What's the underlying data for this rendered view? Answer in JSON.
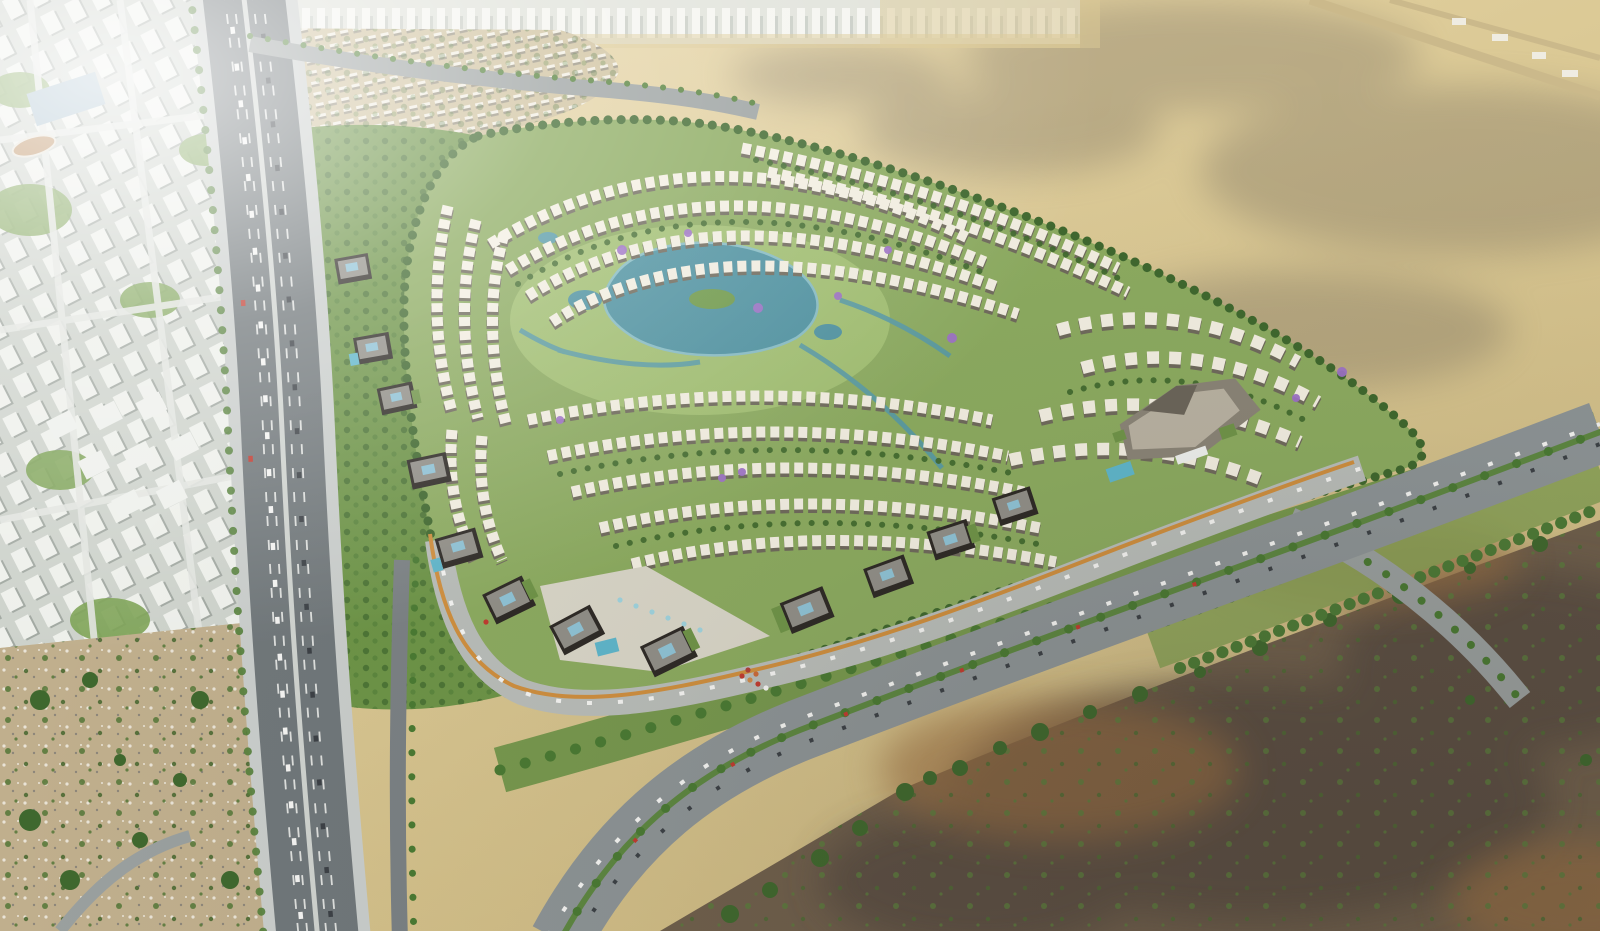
{
  "scene": {
    "type": "architectural-aerial-render",
    "description": "Aerial rendering of a master-planned residential community with curved rows of white villas, a central lagoon park with jacaranda trees, dark glass office buildings along a curved boulevard with an orange cycle path, bordered by an elevated expressway and city blocks on the left, open desert with cloud shadows at the top right, and dark mudflats with scattered trees at the bottom right.",
    "regions": [
      {
        "name": "city-district",
        "label": "existing city with white apartment towers"
      },
      {
        "name": "skyline-strip",
        "label": "distant city skyline on horizon"
      },
      {
        "name": "expressway",
        "label": "multi-lane expressway with traffic"
      },
      {
        "name": "low-rise-district",
        "label": "beige low-rise neighborhood"
      },
      {
        "name": "community-parcel",
        "label": "master-planned villa community"
      },
      {
        "name": "lagoon",
        "label": "central lagoon and park"
      },
      {
        "name": "office-row",
        "label": "dark glass office buildings with green roofs"
      },
      {
        "name": "retail-center",
        "label": "commercial center with pools"
      },
      {
        "name": "boulevard",
        "label": "curved boulevard with orange cycle lane"
      },
      {
        "name": "arterial-road",
        "label": "palm-lined arterial road with traffic"
      },
      {
        "name": "desert",
        "label": "open sand desert with cloud shadows"
      },
      {
        "name": "mudflat",
        "label": "dark brown mudflats with shrubs"
      },
      {
        "name": "rough-terrain",
        "label": "rocky scrubland"
      }
    ],
    "palette": {
      "desert_sand": "#dbc995",
      "desert_light": "#ead9ad",
      "desert_deep": "#cdb981",
      "cloud_shadow": "#6f685c",
      "city_base": "#cdd2cb",
      "city_block_white": "#f4f5f1",
      "city_shadow": "#99a09a",
      "street_light": "#e3e5e1",
      "skyline_base": "#e0e3dd",
      "blue_building": "#a3bccb",
      "district_tan": "#cfc19d",
      "house_white": "#f2eee2",
      "house_roof": "#98917f",
      "greenbelt": "#6d9447",
      "tree_dark": "#3f682e",
      "tree_mid": "#54803a",
      "palm_green": "#4a7a33",
      "parcel_green": "#8cab60",
      "park_green": "#a3c173",
      "villa_white": "#f3efe2",
      "villa_shadow": "#6f6a5c",
      "lagoon_teal": "#4e92a1",
      "lagoon_rim": "#86bcc4",
      "canal_teal": "#579aa6",
      "pool_teal": "#5fb6cb",
      "jacaranda_purple": "#9d72c6",
      "office_dark": "#2e2a26",
      "office_roof": "#918f88",
      "skylight_blue": "#8fc3d6",
      "roof_green": "#6f9448",
      "plaza_paving": "#d9d6c8",
      "cycle_orange": "#cf8f3f",
      "fountain_blue": "#9fd3de",
      "concrete": "#c9cdcb",
      "asphalt": "#70777a",
      "arterial_asphalt": "#8d9496",
      "road_gray": "#9aa09f",
      "lane_mark": "#f2f3f0",
      "median_green": "#5d8741",
      "rough_tan": "#c0af8d",
      "rock_gray": "#e9e3d6",
      "mudflat_brown": "#6f5f4c",
      "mudflat_dark": "#544a3f",
      "mudflat_sun": "#9b6f42",
      "shrub_green": "#5a7a3c",
      "car_white": "#f4f4f2",
      "car_dark": "#3c4146",
      "car_red": "#c03b30",
      "haze_white": "#ffffff"
    }
  }
}
